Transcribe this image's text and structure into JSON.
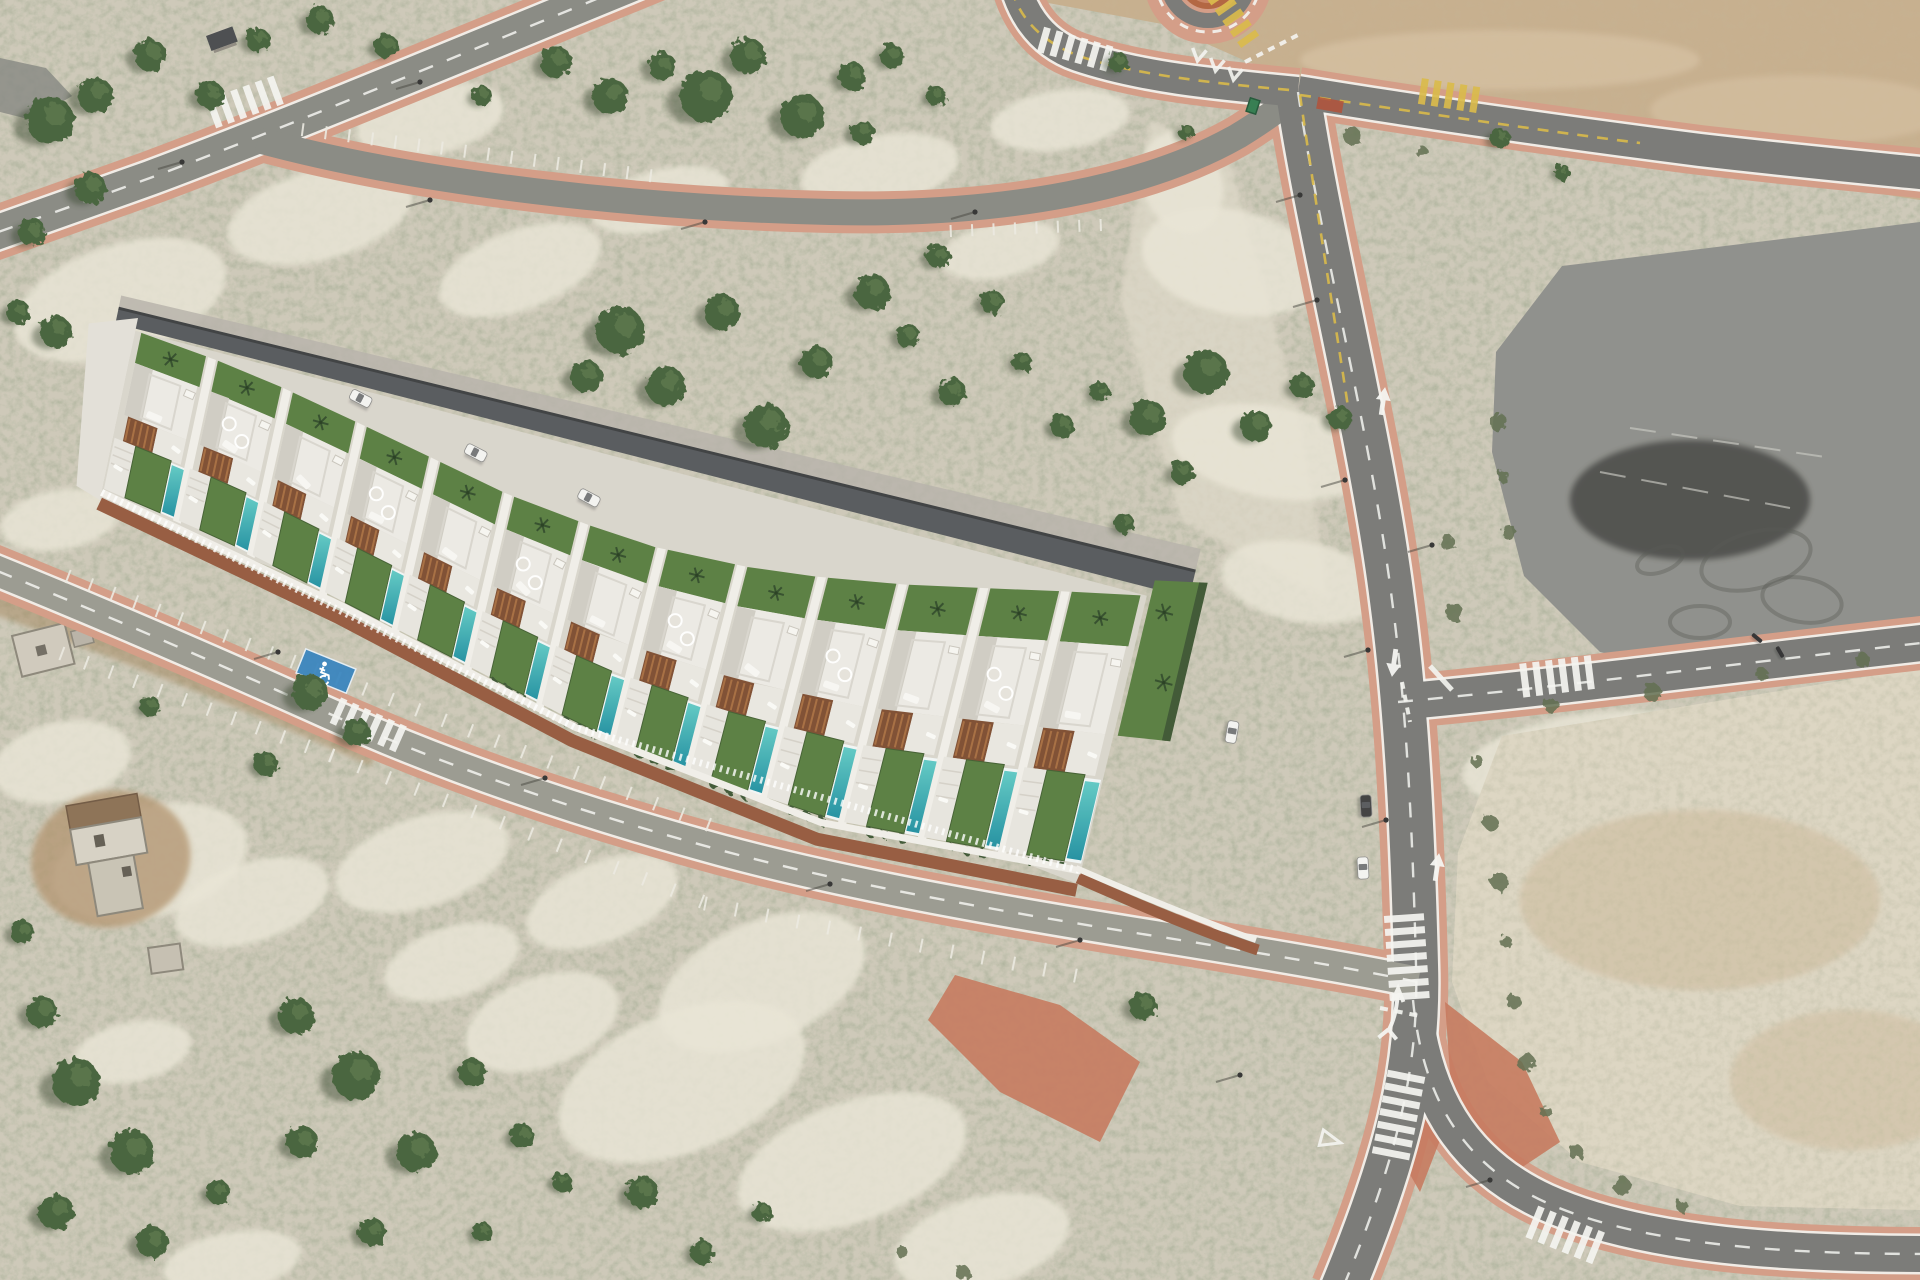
{
  "palette": {
    "terrain": "#cdc8b8",
    "speckle_note": "olive scrub speckle",
    "sand": "#e9e5d6",
    "scree": "#ded8c8",
    "dirt_tan": "#c6ad8c",
    "dirt_tan_light": "#d6c1a1",
    "pad_gray": "#8c8d89",
    "pad_dark": "#77787­4",
    "plot_pale": "#ddd5c2",
    "plot_tan": "#c9b695",
    "road_dark": "#767774",
    "road_mid": "#868781",
    "road_light": "#98988f",
    "sidewalk": "#d39a84",
    "sidewalk_bright": "#c5765a",
    "red_patch": "#b04a31",
    "marking_white": "#f5f5f2",
    "marking_yellow": "#d9b844",
    "house_white": "#eceae5",
    "house_shade": "#cfccc3",
    "house_wall": "#f1efe9",
    "parapet": "#d8d5ce",
    "back_band": "#53565a",
    "back_edge": "#393c3e",
    "alley": "#b6b2a9",
    "lawn": "#567c3e",
    "lawn_dark": "#3f5c2e",
    "pool_a": "#5ec9c4",
    "pool_b": "#1d8ea0",
    "pergola": "#7c4a2e",
    "pergola_slat": "#aa6f40",
    "brick": "#94573c",
    "hedge": "#3a5430",
    "tree": "#435f37",
    "tree_hi": "#567247",
    "tree_shadow": "#2c3b24",
    "shrub": "#5b6a4c",
    "car_white": "#f4f4f2",
    "car_dark": "#3b3b3d",
    "glass": "#5a5d60",
    "blue_bay": "#2e7fbe",
    "dumpster": "#2f7a4c",
    "ruin_wall": "#d6d1c5",
    "ruin_roof": "#8a6e52",
    "ruin_dirt": "#b2946f"
  },
  "roads": [
    {
      "name": "road-top-left",
      "d": "M 655,-25 C 520,30 300,122 150,178 C 70,207 15,226 -30,242",
      "w": 34,
      "sw": 54,
      "color": "road_mid",
      "edge": true,
      "dash": "white"
    },
    {
      "name": "road-loop-parking",
      "d": "M 258,140 C 420,184 640,208 830,212 C 1010,216 1150,186 1238,136 C 1264,120 1284,106 1298,92",
      "w": 26,
      "sw": 42,
      "color": "road_mid",
      "edge": false,
      "dash": null
    },
    {
      "name": "road-from-roundabout",
      "d": "M 1012,-30 C 1018,8 1038,42 1078,56 C 1140,77 1212,84 1298,92",
      "w": 30,
      "sw": 48,
      "color": "road_dark",
      "edge": true,
      "dash": null
    },
    {
      "name": "road-main-ns",
      "d": "M 1298,92 C 1318,230 1372,440 1392,600 C 1408,720 1413,850 1416,965 C 1419,1068 1398,1155 1342,1290",
      "w": 44,
      "sw": 64,
      "color": "road_dark",
      "edge": true,
      "dash": "white"
    },
    {
      "name": "road-southeast-curve",
      "d": "M 1413,1000 C 1422,1092 1458,1162 1545,1202 C 1645,1247 1795,1254 1930,1254",
      "w": 36,
      "sw": 54,
      "color": "road_dark",
      "edge": true,
      "dash": "white"
    },
    {
      "name": "road-east-branch",
      "d": "M 1398,702 C 1550,688 1700,668 1930,642",
      "w": 36,
      "sw": 54,
      "color": "road_dark",
      "edge": true,
      "dash": "white"
    },
    {
      "name": "road-east-top",
      "d": "M 1298,92 C 1420,112 1560,132 1700,150 C 1795,161 1860,167 1930,174",
      "w": 32,
      "sw": 50,
      "color": "road_dark",
      "edge": true,
      "dash": null
    },
    {
      "name": "street-development",
      "d": "M -30,560 C 85,606 210,660 330,714 C 450,768 580,812 720,850 C 860,888 1040,918 1180,940 C 1290,958 1360,970 1418,982",
      "w": 30,
      "sw": 50,
      "color": "road_light",
      "edge": true,
      "dash": "white"
    }
  ],
  "yellow_dashes": [
    "M 1012,-10 C 1020,20 1045,45 1085,58 C 1140,75 1210,83 1290,90",
    "M 1300,95 C 1430,114 1560,133 1640,143",
    "M 1300,95 C 1315,200 1335,320 1350,420"
  ],
  "dirt_shoulder": "M -20,585 C 120,635 260,690 380,745",
  "crosswalks": [
    [
      242,
      103,
      160,
      30,
      6,
      "w"
    ],
    [
      1078,
      50,
      16,
      26,
      6,
      "w"
    ],
    [
      1452,
      96,
      9,
      26,
      5,
      "y"
    ],
    [
      1235,
      20,
      55,
      22,
      5,
      "y"
    ],
    [
      371,
      726,
      24,
      28,
      6,
      "w"
    ],
    [
      1407,
      960,
      86,
      40,
      7,
      "w"
    ],
    [
      1398,
      1118,
      101,
      38,
      7,
      "w"
    ],
    [
      1568,
      1236,
      22,
      34,
      6,
      "w"
    ],
    [
      1560,
      676,
      -7,
      34,
      6,
      "w"
    ]
  ],
  "arrows": [
    [
      1383,
      402,
      8
    ],
    [
      1394,
      662,
      188
    ],
    [
      1437,
      868,
      8
    ]
  ],
  "double_arrow": {
    "x": 1392,
    "y": 1022
  },
  "chevrons": [
    [
      1198,
      58,
      100
    ],
    [
      1216,
      68,
      100
    ],
    [
      1234,
      77,
      100
    ]
  ],
  "giveway_paths": [
    {
      "d": "M 1245,62 L 1298,35",
      "w": 4,
      "dash": "7 6"
    },
    {
      "d": "M 1402,682 L 1410,722",
      "w": 4,
      "dash": "7 6"
    },
    {
      "d": "M 1380,1008 L 1420,1016",
      "w": 4,
      "dash": "8 7"
    },
    {
      "d": "M 1430,666 L 1452,690",
      "w": 5,
      "dash": null
    }
  ],
  "giveway_triangle": {
    "x": 1330,
    "y": 1140,
    "rot": 105
  },
  "parking_rows": [
    {
      "seg": [
        300,
        150,
        648,
        196
      ],
      "n": 15,
      "off": -14,
      "len": 13
    },
    {
      "seg": [
        950,
        212,
        1100,
        206
      ],
      "n": 7,
      "off": 13,
      "len": 12
    },
    {
      "seg": [
        60,
        598,
        330,
        700
      ],
      "n": 12,
      "off": -16,
      "len": 14
    },
    {
      "seg": [
        330,
        700,
        700,
        846
      ],
      "n": 14,
      "off": -16,
      "len": 14
    },
    {
      "seg": [
        70,
        632,
        340,
        734
      ],
      "n": 11,
      "off": 16,
      "len": 14
    },
    {
      "seg": [
        340,
        734,
        710,
        880
      ],
      "n": 13,
      "off": 16,
      "len": 14
    },
    {
      "seg": [
        710,
        880,
        1080,
        952
      ],
      "n": 12,
      "off": 17,
      "len": 14
    }
  ],
  "disabled_bay": {
    "x": 326,
    "y": 671,
    "rot": 22,
    "w": 54,
    "h": 26
  },
  "roundabout": {
    "cx": 1208,
    "cy": -20,
    "r_apron": 64,
    "r_road": 48,
    "r_island": 26
  },
  "red_patch": {
    "x": 1330,
    "y": 105,
    "rot": 10,
    "w": 26,
    "h": 12
  },
  "bright_patches": [
    [
      [
        955,
        975
      ],
      [
        1060,
        1005
      ],
      [
        1140,
        1062
      ],
      [
        1100,
        1142
      ],
      [
        1000,
        1092
      ],
      [
        928,
        1020
      ]
    ],
    [
      [
        1405,
        1042
      ],
      [
        1447,
        1122
      ],
      [
        1420,
        1192
      ],
      [
        1380,
        1122
      ]
    ],
    [
      [
        1445,
        1002
      ],
      [
        1522,
        1062
      ],
      [
        1560,
        1142
      ],
      [
        1500,
        1182
      ],
      [
        1452,
        1102
      ]
    ]
  ],
  "asphalt_pad": {
    "points": [
      [
        1562,
        266
      ],
      [
        1920,
        222
      ],
      [
        1920,
        618
      ],
      [
        1830,
        652
      ],
      [
        1700,
        676
      ],
      [
        1600,
        652
      ],
      [
        1524,
        576
      ],
      [
        1492,
        452
      ],
      [
        1496,
        352
      ]
    ],
    "lines": [
      [
        1630,
        428,
        1832,
        458
      ],
      [
        1600,
        472,
        1790,
        508
      ]
    ],
    "skids": [
      [
        1756,
        560,
        56,
        28,
        -15
      ],
      [
        1802,
        600,
        40,
        22,
        10
      ],
      [
        1700,
        622,
        30,
        16,
        0
      ],
      [
        1660,
        560,
        24,
        12,
        -20
      ]
    ]
  },
  "dirt_topright": {
    "points": [
      [
        1032,
        0
      ],
      [
        1920,
        0
      ],
      [
        1920,
        200
      ],
      [
        1700,
        166
      ],
      [
        1470,
        128
      ],
      [
        1248,
        62
      ],
      [
        1162,
        24
      ]
    ]
  },
  "dirt_plot": {
    "points": [
      [
        1502,
        736
      ],
      [
        1920,
        668
      ],
      [
        1920,
        1210
      ],
      [
        1740,
        1206
      ],
      [
        1580,
        1162
      ],
      [
        1488,
        1082
      ],
      [
        1452,
        982
      ],
      [
        1458,
        852
      ]
    ]
  },
  "gray_corner": {
    "points": [
      [
        0,
        58
      ],
      [
        46,
        68
      ],
      [
        72,
        96
      ],
      [
        32,
        120
      ],
      [
        0,
        112
      ]
    ]
  },
  "scree": {
    "points": [
      [
        1150,
        120
      ],
      [
        1230,
        160
      ],
      [
        1300,
        420
      ],
      [
        1330,
        600
      ],
      [
        1180,
        520
      ],
      [
        1120,
        300
      ]
    ]
  },
  "sand_patches": [
    [
      120,
      300,
      110,
      55,
      -18
    ],
    [
      320,
      215,
      95,
      45,
      -15
    ],
    [
      520,
      270,
      85,
      40,
      -20
    ],
    [
      430,
      120,
      75,
      35,
      -12
    ],
    [
      660,
      200,
      70,
      30,
      -15
    ],
    [
      880,
      170,
      80,
      35,
      -10
    ],
    [
      1000,
      250,
      60,
      28,
      -12
    ],
    [
      190,
      430,
      70,
      35,
      -14
    ],
    [
      60,
      520,
      60,
      30,
      -10
    ],
    [
      1060,
      120,
      70,
      30,
      -8
    ],
    [
      1232,
      262,
      52,
      92,
      -78
    ],
    [
      1272,
      452,
      46,
      102,
      -80
    ],
    [
      1302,
      582,
      40,
      82,
      -80
    ],
    [
      1182,
      182,
      40,
      52,
      -20
    ],
    [
      150,
      862,
      100,
      55,
      -15
    ],
    [
      62,
      762,
      70,
      40,
      -12
    ],
    [
      252,
      902,
      80,
      40,
      -18
    ],
    [
      422,
      862,
      90,
      45,
      -18
    ],
    [
      602,
      902,
      80,
      40,
      -22
    ],
    [
      762,
      982,
      110,
      60,
      -24
    ],
    [
      682,
      1082,
      130,
      70,
      -22
    ],
    [
      852,
      1162,
      120,
      60,
      -20
    ],
    [
      982,
      1242,
      90,
      45,
      -15
    ],
    [
      542,
      1022,
      80,
      45,
      -20
    ],
    [
      452,
      962,
      70,
      35,
      -18
    ],
    [
      132,
      1052,
      60,
      30,
      -12
    ],
    [
      232,
      1262,
      70,
      30,
      -10
    ],
    [
      1602,
      762,
      140,
      50,
      -6
    ],
    [
      1752,
      852,
      160,
      70,
      -8
    ],
    [
      1652,
      1002,
      120,
      60,
      -10
    ],
    [
      1822,
      1102,
      100,
      50,
      -8
    ],
    [
      1582,
      902,
      90,
      45,
      -8
    ]
  ],
  "trees": [
    [
      50,
      120,
      24
    ],
    [
      95,
      95,
      18
    ],
    [
      150,
      55,
      16
    ],
    [
      210,
      95,
      14
    ],
    [
      258,
      40,
      12
    ],
    [
      320,
      20,
      14
    ],
    [
      386,
      46,
      12
    ],
    [
      90,
      188,
      16
    ],
    [
      32,
      232,
      14
    ],
    [
      18,
      312,
      12
    ],
    [
      556,
      62,
      16
    ],
    [
      610,
      96,
      18
    ],
    [
      662,
      66,
      14
    ],
    [
      706,
      96,
      26
    ],
    [
      748,
      56,
      18
    ],
    [
      802,
      116,
      22
    ],
    [
      852,
      76,
      14
    ],
    [
      892,
      56,
      12
    ],
    [
      936,
      96,
      10
    ],
    [
      862,
      132,
      12
    ],
    [
      482,
      96,
      10
    ],
    [
      620,
      330,
      24
    ],
    [
      586,
      376,
      16
    ],
    [
      666,
      386,
      20
    ],
    [
      722,
      312,
      18
    ],
    [
      766,
      426,
      22
    ],
    [
      816,
      362,
      16
    ],
    [
      872,
      292,
      18
    ],
    [
      908,
      336,
      12
    ],
    [
      952,
      392,
      14
    ],
    [
      992,
      302,
      12
    ],
    [
      1022,
      362,
      10
    ],
    [
      938,
      256,
      12
    ],
    [
      1062,
      426,
      12
    ],
    [
      1100,
      392,
      10
    ],
    [
      1148,
      418,
      18
    ],
    [
      1206,
      372,
      22
    ],
    [
      1256,
      426,
      16
    ],
    [
      1302,
      386,
      12
    ],
    [
      1182,
      472,
      12
    ],
    [
      1340,
      418,
      12
    ],
    [
      56,
      332,
      16
    ],
    [
      150,
      706,
      10
    ],
    [
      310,
      692,
      18
    ],
    [
      356,
      732,
      14
    ],
    [
      266,
      764,
      12
    ],
    [
      42,
      1012,
      16
    ],
    [
      76,
      1082,
      24
    ],
    [
      132,
      1152,
      22
    ],
    [
      56,
      1212,
      18
    ],
    [
      152,
      1242,
      16
    ],
    [
      218,
      1192,
      12
    ],
    [
      22,
      932,
      12
    ],
    [
      296,
      1016,
      18
    ],
    [
      356,
      1076,
      24
    ],
    [
      302,
      1142,
      16
    ],
    [
      416,
      1152,
      20
    ],
    [
      372,
      1232,
      14
    ],
    [
      472,
      1072,
      14
    ],
    [
      522,
      1136,
      12
    ],
    [
      482,
      1232,
      10
    ],
    [
      562,
      1182,
      10
    ],
    [
      642,
      1192,
      16
    ],
    [
      702,
      1252,
      12
    ],
    [
      762,
      1212,
      10
    ],
    [
      1143,
      1006,
      14
    ],
    [
      1125,
      524,
      10
    ],
    [
      1500,
      138,
      10
    ],
    [
      1562,
      172,
      8
    ],
    [
      1118,
      62,
      10
    ],
    [
      1186,
      132,
      8
    ]
  ],
  "shrubs": [
    [
      1478,
      762
    ],
    [
      1490,
      822
    ],
    [
      1500,
      882
    ],
    [
      1506,
      942
    ],
    [
      1514,
      1002
    ],
    [
      1526,
      1062
    ],
    [
      1546,
      1112
    ],
    [
      1576,
      1152
    ],
    [
      1622,
      1186
    ],
    [
      1682,
      1206
    ],
    [
      1552,
      706
    ],
    [
      1652,
      692
    ],
    [
      1762,
      674
    ],
    [
      1862,
      660
    ],
    [
      1498,
      422
    ],
    [
      1503,
      476
    ],
    [
      1509,
      532
    ],
    [
      1352,
      136
    ],
    [
      1422,
      152
    ],
    [
      1447,
      542
    ],
    [
      1454,
      612
    ],
    [
      902,
      1252
    ],
    [
      962,
      1272
    ]
  ],
  "development": {
    "units": 13,
    "back": [
      [
        138,
        318
      ],
      [
        250,
        358
      ],
      [
        380,
        418
      ],
      [
        510,
        480
      ],
      [
        640,
        528
      ],
      [
        780,
        556
      ],
      [
        920,
        566
      ],
      [
        1060,
        570
      ],
      [
        1152,
        574
      ]
    ],
    "front": [
      [
        100,
        500
      ],
      [
        220,
        552
      ],
      [
        340,
        614
      ],
      [
        460,
        676
      ],
      [
        580,
        740
      ],
      [
        700,
        792
      ],
      [
        830,
        838
      ],
      [
        960,
        864
      ],
      [
        1078,
        884
      ]
    ],
    "v": {
      "alley0": -0.085,
      "alley1": -0.015,
      "band0": -0.015,
      "band1": 0.07,
      "gard0": 0.07,
      "gard1": 0.235,
      "roof0": 0.235,
      "roof1": 0.52,
      "terr0": 0.52,
      "terr1": 0.655,
      "yard0": 0.655,
      "yard1": 0.935,
      "balustrade": 0.958,
      "brick": 1.02
    },
    "f": {
      "patio0": 0.02,
      "patio1": 0.3,
      "lawn0": 0.3,
      "lawn1": 0.77,
      "pool0": 0.79,
      "pool1": 0.97,
      "pergola1": 0.52
    },
    "skylight_units": [
      1,
      3,
      5,
      7,
      9,
      11
    ],
    "hedge_from_unit": 5,
    "wall_extension": "M 1078,878 C 1150,910 1215,936 1258,950",
    "balustrade_extension": "M 1076,868 C 1150,900 1215,926 1256,940"
  },
  "vehicles": {
    "alley_cars_u": [
      0.225,
      0.345,
      0.46
    ],
    "cars_abs": [
      {
        "x": 1232,
        "y": 732,
        "rot": 100,
        "color": "white",
        "name": "car-development-east"
      },
      {
        "x": 1366,
        "y": 806,
        "rot": 87,
        "color": "dark",
        "name": "car-parked-road-dark"
      },
      {
        "x": 1363,
        "y": 868,
        "rot": 87,
        "color": "white",
        "name": "car-parked-road-white"
      }
    ],
    "motorbikes": [
      [
        1757,
        638,
        40
      ],
      [
        1780,
        652,
        60
      ]
    ]
  },
  "furniture": {
    "dumpster": {
      "x": 1253,
      "y": 106,
      "rot": 18
    },
    "shelter": {
      "x": 206,
      "y": 36,
      "rot": -20
    },
    "lamps": [
      [
        278,
        652
      ],
      [
        545,
        778
      ],
      [
        830,
        884
      ],
      [
        1080,
        940
      ],
      [
        1317,
        300
      ],
      [
        1345,
        480
      ],
      [
        1368,
        650
      ],
      [
        1386,
        820
      ],
      [
        1432,
        545
      ],
      [
        1300,
        195
      ],
      [
        430,
        200
      ],
      [
        705,
        222
      ],
      [
        975,
        212
      ],
      [
        182,
        162
      ],
      [
        420,
        82
      ],
      [
        1240,
        1075
      ],
      [
        1490,
        1180
      ]
    ]
  },
  "ruins": [
    {
      "x": 12,
      "y": 636,
      "rot": -14,
      "type": "small"
    },
    {
      "x": 66,
      "y": 806,
      "rot": -10,
      "type": "large"
    },
    {
      "x": 148,
      "y": 948,
      "rot": -8,
      "type": "tiny"
    }
  ]
}
